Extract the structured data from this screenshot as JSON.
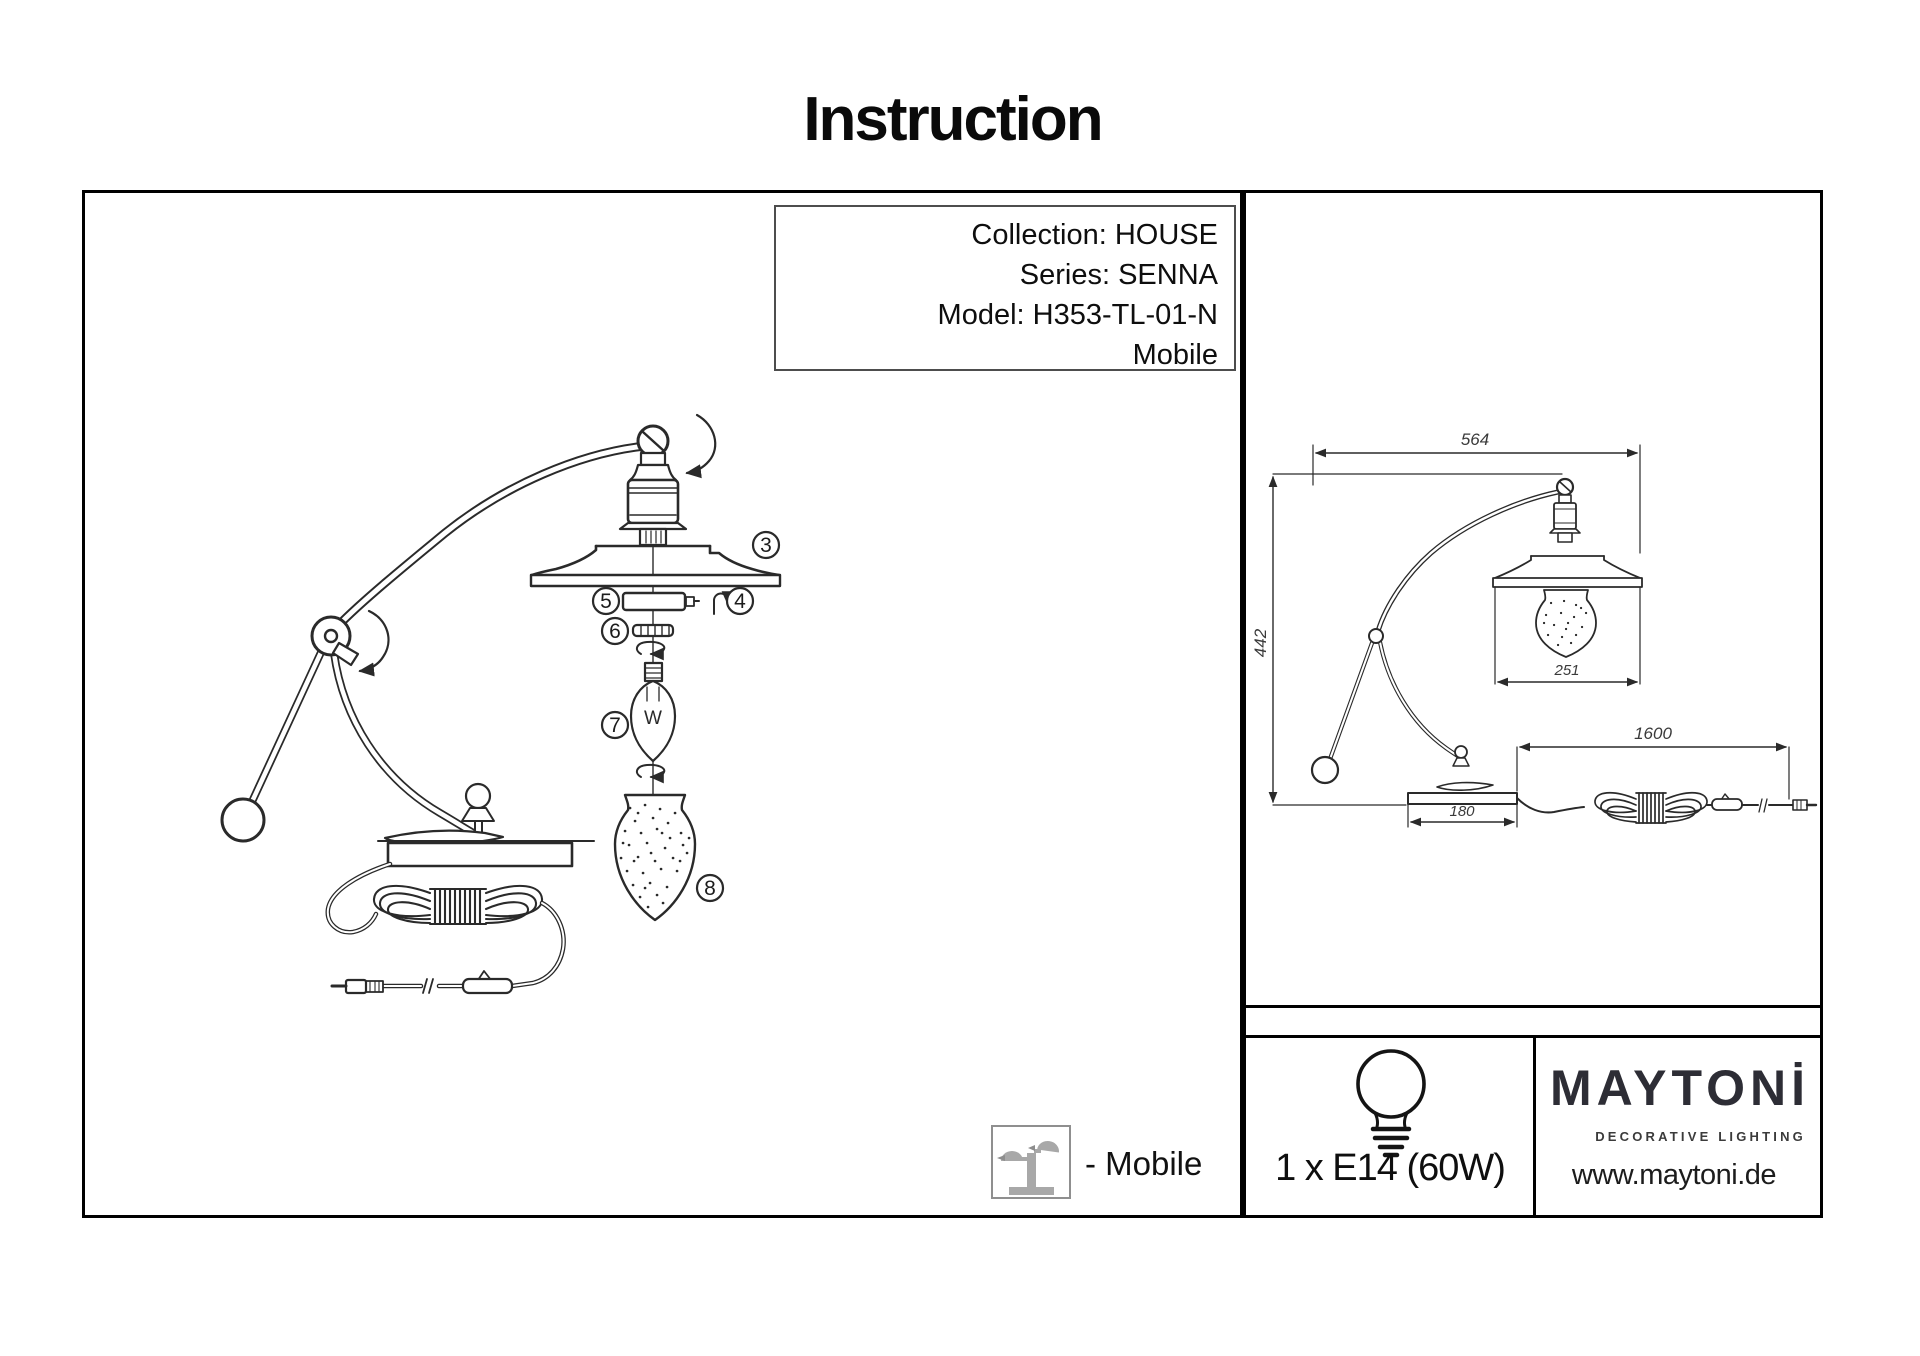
{
  "page": {
    "title": "Instruction"
  },
  "colors": {
    "line": "#2a2a2a",
    "frame": "#000000",
    "icon_gray": "#a8a8a8",
    "logo": "#2d2d35"
  },
  "info_box": {
    "collection": "Collection: HOUSE",
    "series": "Series: SENNA",
    "model": "Model: H353-TL-01-N",
    "variant": "Mobile"
  },
  "exploded": {
    "parts": {
      "p3": "3",
      "p4": "4",
      "p5": "5",
      "p6": "6",
      "p7": "7",
      "p8": "8"
    },
    "filament": "W"
  },
  "dims": {
    "w": "564",
    "h": "442",
    "shade": "251",
    "base": "180",
    "cord": "1600"
  },
  "legend": {
    "mobile": "- Mobile"
  },
  "spec": {
    "lamp": "1 x E14 (60W)"
  },
  "brand": {
    "logo": "MAYTONİ",
    "tagline": "DECORATIVE LIGHTING",
    "site": "www.maytoni.de"
  }
}
